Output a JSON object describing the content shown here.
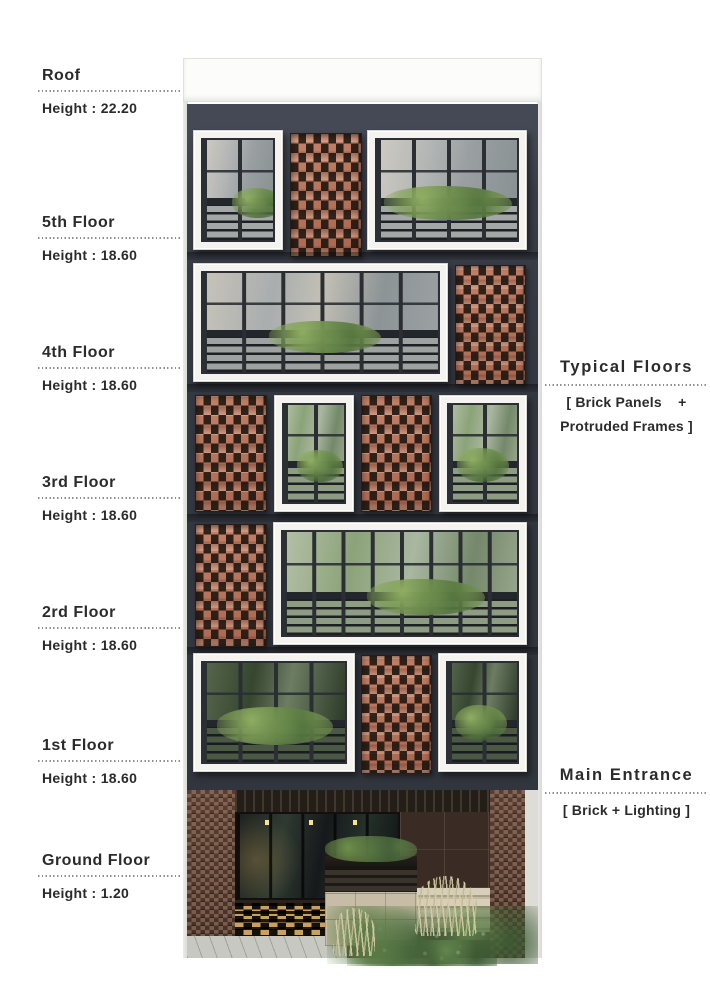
{
  "palette": {
    "text": "#2b2b2b",
    "dotted-line": "#8f8f8f",
    "facade-charcoal": "#383c45",
    "brick": "#b5735a",
    "frame-white": "#f4f3f0",
    "stone-beige": "#cdc3ab",
    "ground-brick-brown": "#50352a",
    "foliage-green": "#54763f"
  },
  "left_annotations": [
    {
      "id": "roof",
      "label": "Roof",
      "height": "Height : 22.20"
    },
    {
      "id": "5th",
      "label": "5th Floor",
      "height": "Height : 18.60"
    },
    {
      "id": "4th",
      "label": "4th Floor",
      "height": "Height : 18.60"
    },
    {
      "id": "3rd",
      "label": "3rd Floor",
      "height": "Height : 18.60"
    },
    {
      "id": "2nd",
      "label": "2rd Floor",
      "height": "Height : 18.60"
    },
    {
      "id": "1st",
      "label": "1st Floor",
      "height": "Height : 18.60"
    },
    {
      "id": "ground",
      "label": "Ground Floor",
      "height": "Height : 1.20"
    }
  ],
  "right_annotations": {
    "typical_floors": {
      "label": "Typical Floors",
      "note_line1": "[ Brick Panels    +",
      "note_line2": "Protruded Frames ]"
    },
    "main_entrance": {
      "label": "Main Entrance",
      "note_line1": "[ Brick + Lighting ]"
    }
  }
}
